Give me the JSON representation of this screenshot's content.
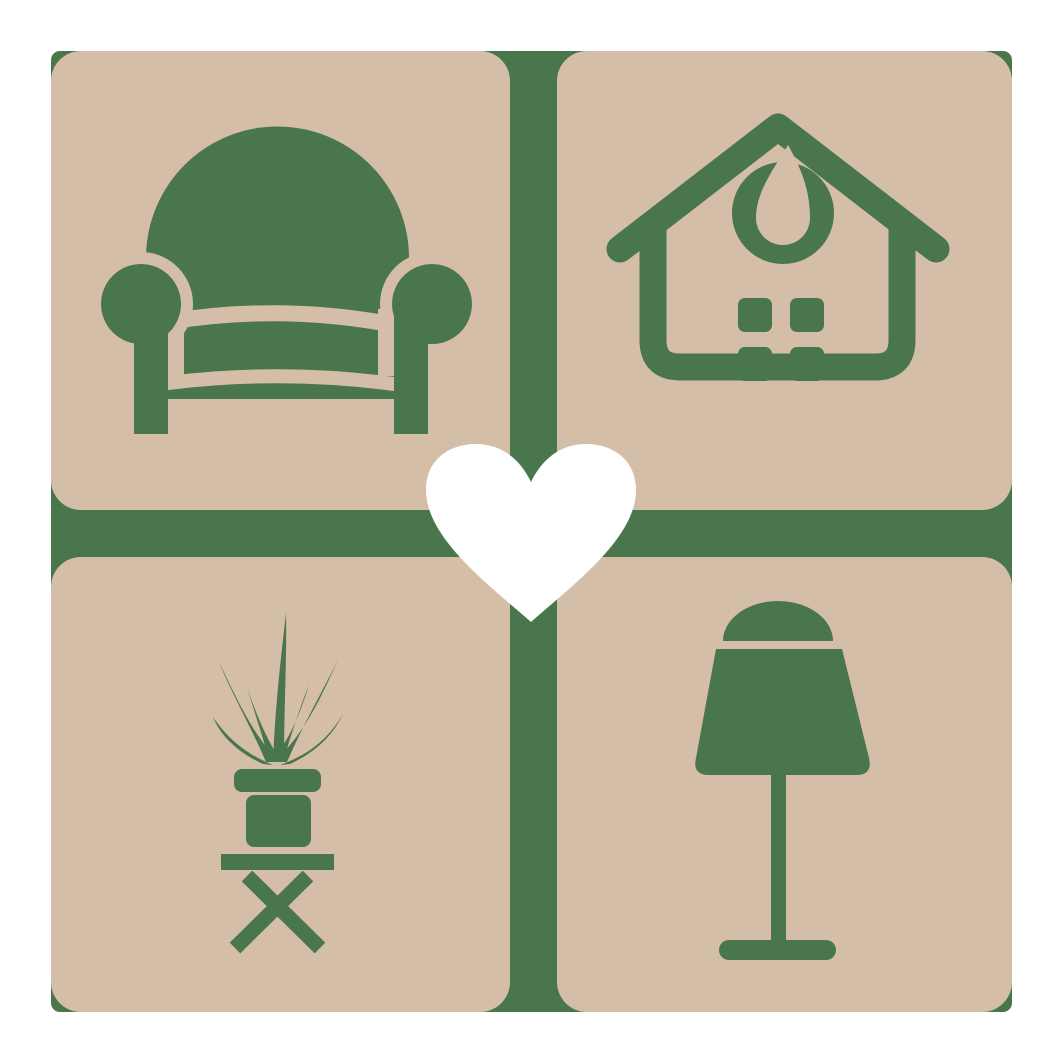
{
  "logo": {
    "name": "home-and-furniture-love-logo",
    "center": {
      "icon": "heart-icon"
    },
    "quadrants": [
      {
        "position": "top-left",
        "icon": "armchair-icon"
      },
      {
        "position": "top-right",
        "icon": "house-icon"
      },
      {
        "position": "bottom-left",
        "icon": "potted-plant-icon"
      },
      {
        "position": "bottom-right",
        "icon": "table-lamp-icon"
      }
    ]
  },
  "colors": {
    "page_background": "#ffffff",
    "backdrop_green": "#4a764d",
    "icon_green": "#4a764d",
    "tile_beige": "#d5bea7",
    "heart_white": "#ffffff"
  }
}
